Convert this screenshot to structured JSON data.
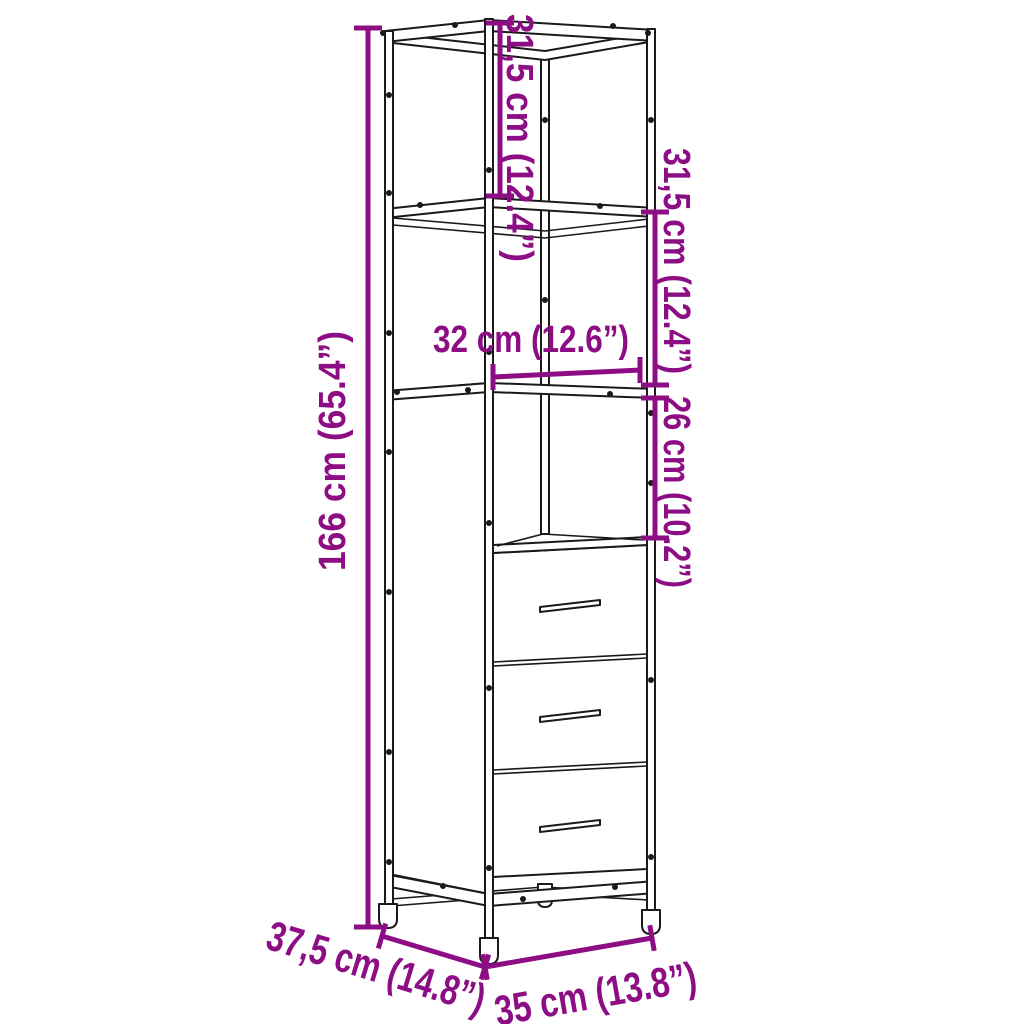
{
  "figure": {
    "name": "cabinet-dimension-diagram",
    "background_color": "#ffffff",
    "outline_color": "#1a1a1a",
    "dimension_color": "#8d0e84"
  },
  "dimensions": {
    "height": {
      "label": "166 cm (65.4”)"
    },
    "top_section_height": {
      "label": "31,5 cm (12.4”)"
    },
    "second_section_height": {
      "label": "31,5 cm (12.4”)"
    },
    "compartment_height": {
      "label": "26 cm (10.2”)"
    },
    "inner_width": {
      "label": "32 cm (12.6”)"
    },
    "depth": {
      "label": "37,5 cm (14.8”)"
    },
    "width": {
      "label": "35 cm (13.8”)"
    }
  }
}
